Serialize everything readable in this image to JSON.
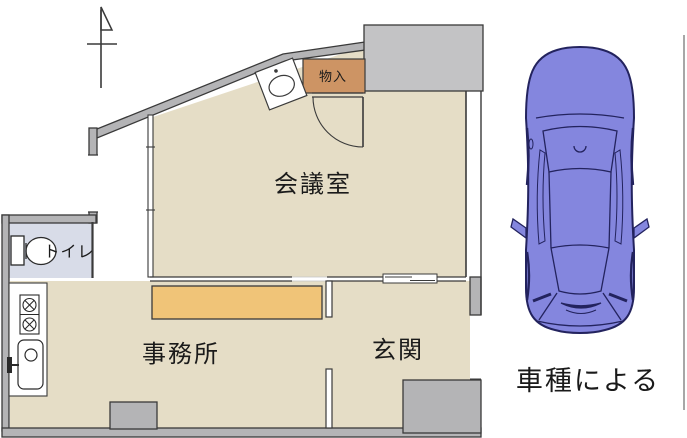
{
  "floor_plan": {
    "rooms": {
      "meeting_room": {
        "label": "会議室"
      },
      "office": {
        "label": "事務所"
      },
      "entrance": {
        "label": "玄関"
      },
      "toilet": {
        "label": "トイレ"
      },
      "storage": {
        "label": "物入"
      }
    },
    "colors": {
      "floor": "#e5ddc6",
      "toilet_floor": "#d8dce8",
      "wall": "#b4b4b6",
      "wall_light": "#c3c3c5",
      "closet": "#cd9464",
      "counter": "#f0c478",
      "outline": "#3a3a3a"
    }
  },
  "car": {
    "caption": "車種による",
    "body_color": "#8486de",
    "line_color": "#23235e"
  }
}
